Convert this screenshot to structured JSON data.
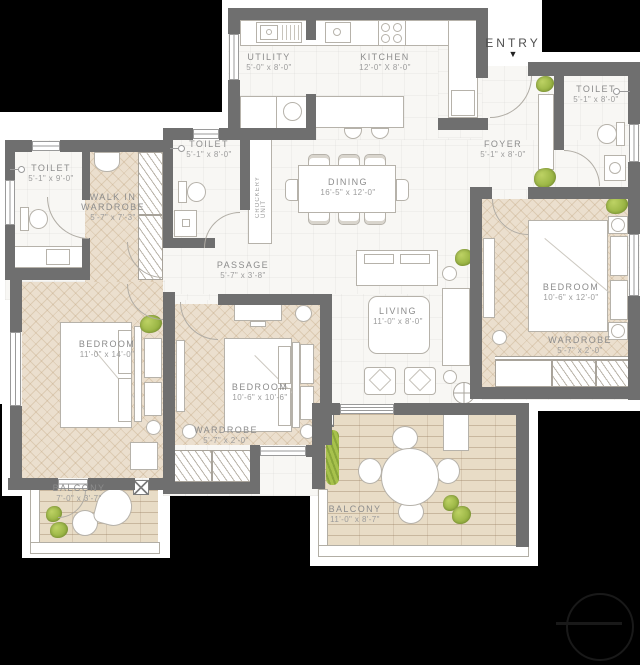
{
  "plan": {
    "entry": {
      "label": "ENTRY"
    },
    "utility": {
      "name": "UTILITY",
      "dims": "5'-0\" x 8'-0\""
    },
    "kitchen": {
      "name": "KITCHEN",
      "dims": "12'-0\" X 8'-0\""
    },
    "toilet_top_right": {
      "name": "TOILET",
      "dims": "5'-1\" x 8'-0\""
    },
    "foyer": {
      "name": "FOYER",
      "dims": "5'-1\" x 8'-0\""
    },
    "toilet_left": {
      "name": "TOILET",
      "dims": "5'-1\" x 9'-0\""
    },
    "walk_in_wardrobe": {
      "name_line1": "WALK IN",
      "name_line2": "WARDROBE",
      "dims": "5'-7\" x 7'-3\""
    },
    "toilet_middle": {
      "name": "TOILET",
      "dims": "5'-1\" x 8'-0\""
    },
    "crockery_unit": {
      "name": "CROCKERY UNIT"
    },
    "dining": {
      "name": "DINING",
      "dims": "16'-5\" x 12'-0\""
    },
    "passage": {
      "name": "PASSAGE",
      "dims": "5'-7\" x 3'-8\""
    },
    "living": {
      "name": "LIVING",
      "dims": "11'-0\" x 8'-0\""
    },
    "bedroom_right": {
      "name": "BEDROOM",
      "dims": "10'-6\" x 12'-0\""
    },
    "wardrobe_right": {
      "name": "WARDROBE",
      "dims": "5'-7\" x 2'-0\""
    },
    "bedroom_left": {
      "name": "BEDROOM",
      "dims": "11'-0\" x 14'-0\""
    },
    "bedroom_middle": {
      "name": "BEDROOM",
      "dims": "10'-6\" x 10'-6\""
    },
    "wardrobe_middle": {
      "name": "WARDROBE",
      "dims": "5'-7\" x 2'-0\""
    },
    "balcony_left": {
      "name": "BALCONY",
      "dims": "7'-0\" x 3'-7\""
    },
    "balcony_main": {
      "name": "BALCONY",
      "dims": "11'-0\" x 8'-7\""
    }
  },
  "icons": {
    "entry_arrow": "▼"
  },
  "colors": {
    "background": "#000000",
    "wall": "#6f6f6f",
    "tile_floor": "#f8f7f4",
    "wood_floor": "#ebdfce",
    "plank_floor": "#e8dcc6",
    "plant": "#9cb545",
    "label_text": "#8c8c8c"
  }
}
